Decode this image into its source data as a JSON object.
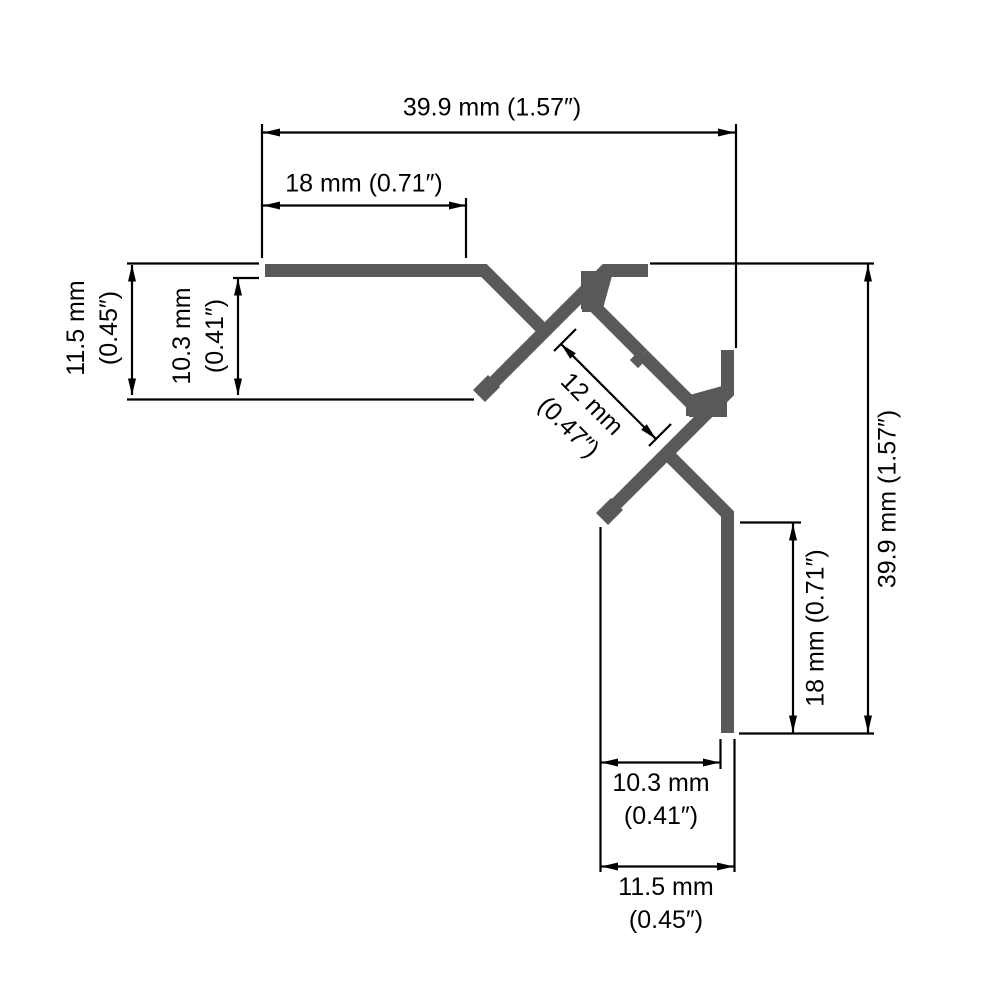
{
  "drawing": {
    "profile_color": "#58595B",
    "line_color": "#000000",
    "background_color": "#ffffff",
    "labels": {
      "top_overall_width": "39.9 mm (1.57″)",
      "top_flange_width": "18 mm (0.71″)",
      "left_outer_height": {
        "mm": "11.5 mm",
        "inches": "(0.45″)"
      },
      "left_inner_height": {
        "mm": "10.3 mm",
        "inches": "(0.41″)"
      },
      "channel_opening": {
        "mm": "12 mm",
        "inches": "(0.47″)"
      },
      "right_overall_height": "39.9 mm (1.57″)",
      "right_flange_height": "18 mm (0.71″)",
      "bottom_inner_width": {
        "mm": "10.3 mm",
        "inches": "(0.41″)"
      },
      "bottom_outer_width": {
        "mm": "11.5 mm",
        "inches": "(0.45″)"
      }
    }
  }
}
